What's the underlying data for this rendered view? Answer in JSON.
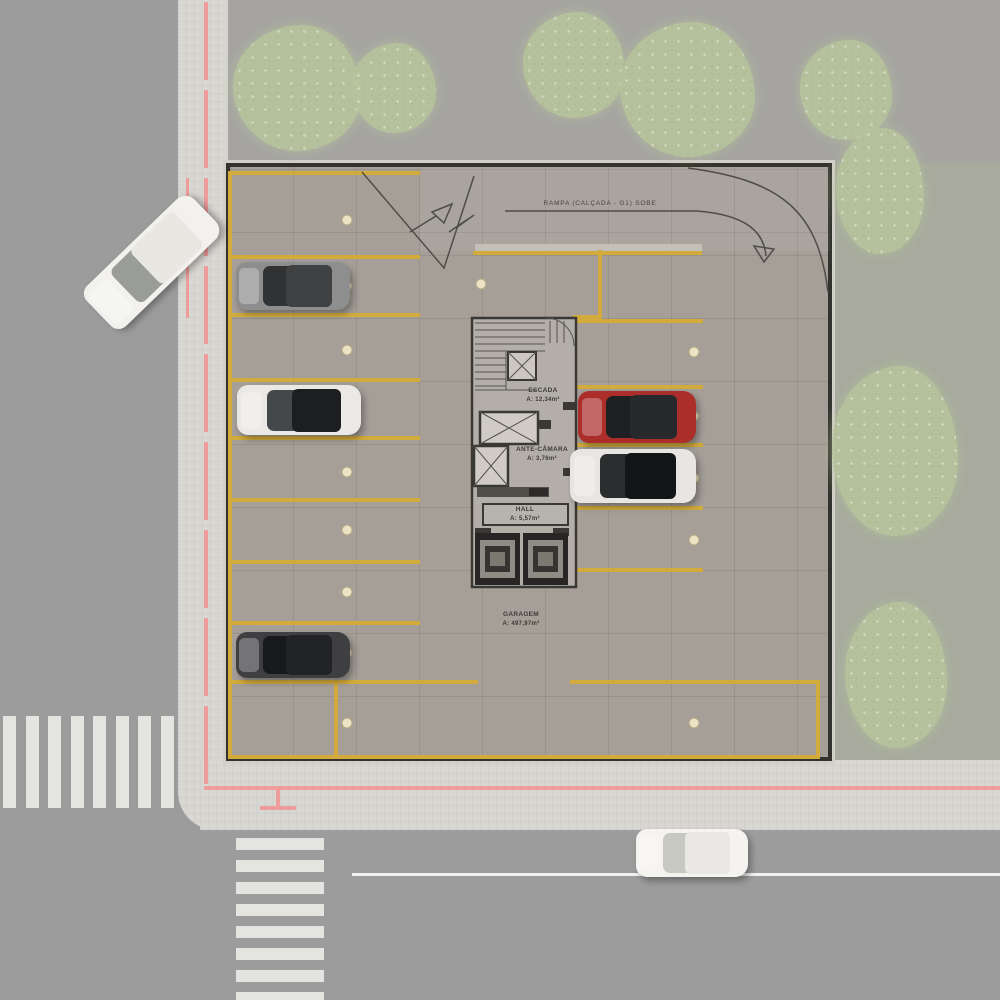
{
  "labels": {
    "ramp": "RAMPA (CALÇADA - G1) SOBE",
    "stair_name": "ESCADA",
    "stair_area": "A: 12,34m²",
    "antechamber_name": "ANTE-CÂMARA",
    "antechamber_area": "A: 3,76m²",
    "hall_name": "HALL",
    "hall_area": "A: 5,57m²",
    "garage_name": "GARAGEM",
    "garage_area": "A: 497,97m²"
  },
  "colors": {
    "street": "#9c9c9c",
    "sidewalk": "#d9d7d2",
    "ground_top": "#a5a4a0",
    "grass": "#a7aa9d",
    "garage_floor": "#a59f98",
    "garage_wall": "#34322d",
    "parking_line_yellow": "#d2ab3c",
    "property_line_red": "#ef9d9b",
    "lane_line_white": "#f2f2ee",
    "tree_green": "#b7c49c",
    "marker_beige": "#ece3c4"
  },
  "parking_lines": [
    [
      228,
      171,
      192,
      4
    ],
    [
      228,
      171,
      4,
      588
    ],
    [
      230,
      255,
      190,
      4
    ],
    [
      230,
      313,
      190,
      4
    ],
    [
      230,
      378,
      190,
      4
    ],
    [
      230,
      436,
      190,
      4
    ],
    [
      230,
      498,
      190,
      4
    ],
    [
      230,
      560,
      190,
      4
    ],
    [
      230,
      621,
      190,
      4
    ],
    [
      228,
      680,
      250,
      4
    ],
    [
      570,
      680,
      250,
      4
    ],
    [
      228,
      755,
      592,
      4
    ],
    [
      334,
      684,
      4,
      71
    ],
    [
      816,
      684,
      4,
      71
    ],
    [
      598,
      250,
      4,
      68
    ],
    [
      573,
      315,
      29,
      4
    ],
    [
      573,
      315,
      4,
      257
    ],
    [
      577,
      319,
      126,
      4
    ],
    [
      577,
      385,
      126,
      4
    ],
    [
      577,
      443,
      126,
      4
    ],
    [
      577,
      506,
      126,
      4
    ],
    [
      577,
      568,
      126,
      4
    ],
    [
      473,
      251,
      229,
      4
    ]
  ],
  "markers": [
    [
      347,
      220
    ],
    [
      347,
      286
    ],
    [
      347,
      350
    ],
    [
      347,
      410
    ],
    [
      347,
      472
    ],
    [
      347,
      530
    ],
    [
      347,
      592
    ],
    [
      347,
      653
    ],
    [
      347,
      723
    ],
    [
      481,
      284
    ],
    [
      694,
      352
    ],
    [
      694,
      416
    ],
    [
      694,
      478
    ],
    [
      694,
      540
    ],
    [
      694,
      723
    ]
  ],
  "cars": [
    {
      "name": "street-car-left",
      "cx": 152,
      "cy": 262,
      "len": 148,
      "wid": 56,
      "angle": -44,
      "body": "#f2f1ed",
      "glass": "#9a9c99",
      "roof": "#e8e7e2"
    },
    {
      "name": "parked-car-gray",
      "cx": 293,
      "cy": 286,
      "len": 114,
      "wid": 48,
      "angle": 0,
      "body": "#8e8e8e",
      "glass": "#303234",
      "roof": "#3f4143"
    },
    {
      "name": "parked-car-white",
      "cx": 299,
      "cy": 410,
      "len": 124,
      "wid": 50,
      "angle": 0,
      "body": "#ebe9e5",
      "glass": "#45484b",
      "roof": "#1d1e20"
    },
    {
      "name": "parked-car-black",
      "cx": 293,
      "cy": 655,
      "len": 114,
      "wid": 46,
      "angle": 0,
      "body": "#3f3f42",
      "glass": "#18191b",
      "roof": "#222326"
    },
    {
      "name": "parked-car-red",
      "cx": 637,
      "cy": 417,
      "len": 118,
      "wid": 52,
      "angle": 0,
      "body": "#ac2e2b",
      "glass": "#1e2023",
      "roof": "#27292c"
    },
    {
      "name": "parked-car-white-black-roof",
      "cx": 633,
      "cy": 476,
      "len": 126,
      "wid": 54,
      "angle": 0,
      "body": "#e8e6e2",
      "glass": "#2b2d2f",
      "roof": "#141517"
    },
    {
      "name": "street-car-bottom",
      "cx": 692,
      "cy": 853,
      "len": 112,
      "wid": 48,
      "angle": 0,
      "body": "#f4f3f0",
      "glass": "#c8c8c3",
      "roof": "#eae8e4"
    }
  ],
  "trees": [
    [
      233,
      25,
      128,
      126
    ],
    [
      352,
      43,
      84,
      90
    ],
    [
      523,
      12,
      102,
      106
    ],
    [
      620,
      22,
      135,
      135
    ],
    [
      800,
      40,
      92,
      100
    ],
    [
      836,
      128,
      88,
      126
    ],
    [
      832,
      366,
      126,
      170
    ],
    [
      845,
      602,
      102,
      146
    ]
  ],
  "crosswalks": {
    "left": {
      "x": 3,
      "y": 716,
      "stripe_w": 13,
      "stripe_h": 92,
      "step": 22.5,
      "count": 8,
      "advance": "x"
    },
    "bottom": {
      "x": 236,
      "y": 838,
      "stripe_w": 88,
      "stripe_h": 12,
      "step": 22,
      "count": 8,
      "advance": "y"
    }
  },
  "property_lines": [
    {
      "x": 204,
      "y": 2,
      "w": 4,
      "h": 784,
      "dashed": true
    },
    {
      "x": 186,
      "y": 178,
      "w": 3,
      "h": 140,
      "dashed": false
    },
    {
      "x": 204,
      "y": 786,
      "w": 796,
      "h": 4,
      "dashed": false
    },
    {
      "x": 276,
      "y": 788,
      "w": 4,
      "h": 20,
      "dashed": false
    },
    {
      "x": 260,
      "y": 806,
      "w": 36,
      "h": 4,
      "dashed": false
    }
  ],
  "lane_line": {
    "x": 352,
    "y": 873,
    "w": 648,
    "h": 3
  }
}
